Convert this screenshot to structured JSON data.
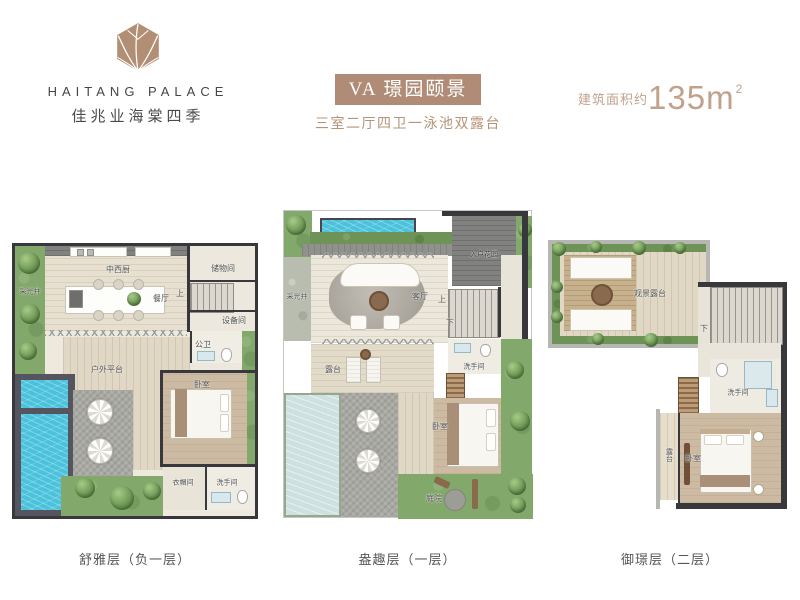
{
  "brand": {
    "name_en": "HAITANG PALACE",
    "name_cn": "佳兆业海棠四季"
  },
  "header": {
    "unit_title": "VA 璟园颐景",
    "subtitle": "三室二厅四卫一泳池双露台",
    "area_label": "建筑面积约",
    "area_number": "135m",
    "area_exponent": "2"
  },
  "plans": {
    "basement": {
      "caption": "舒雅层（负一层）",
      "labels": {
        "lightwell": "采光井",
        "kitchen": "中西厨",
        "dining": "餐厅",
        "storage": "储物间",
        "up": "上",
        "equipment": "设备间",
        "bath": "公卫",
        "outdoor_deck": "户外平台",
        "bedroom": "卧室",
        "closet": "衣帽间",
        "washroom": "洗手间"
      }
    },
    "first": {
      "caption": "盎趣层（一层）",
      "labels": {
        "entry_garden": "入户花园",
        "lightwell": "采光井",
        "living": "客厅",
        "up": "上",
        "down": "下",
        "terrace": "露台",
        "washroom": "洗手间",
        "bedroom": "卧室",
        "courtyard": "庭院"
      }
    },
    "second": {
      "caption": "御璟层（二层）",
      "labels": {
        "view_terrace": "观景露台",
        "down": "下",
        "washroom": "洗手间",
        "bedroom": "卧室",
        "terrace": "露台"
      }
    }
  },
  "colors": {
    "accent_tan": "#b08c77",
    "wall_dark": "#38383c",
    "pool_blue": "#4ac2dc",
    "pool_pale": "#cfe0e1",
    "greenery": "#82a86b",
    "caption_gray": "#57575a"
  }
}
